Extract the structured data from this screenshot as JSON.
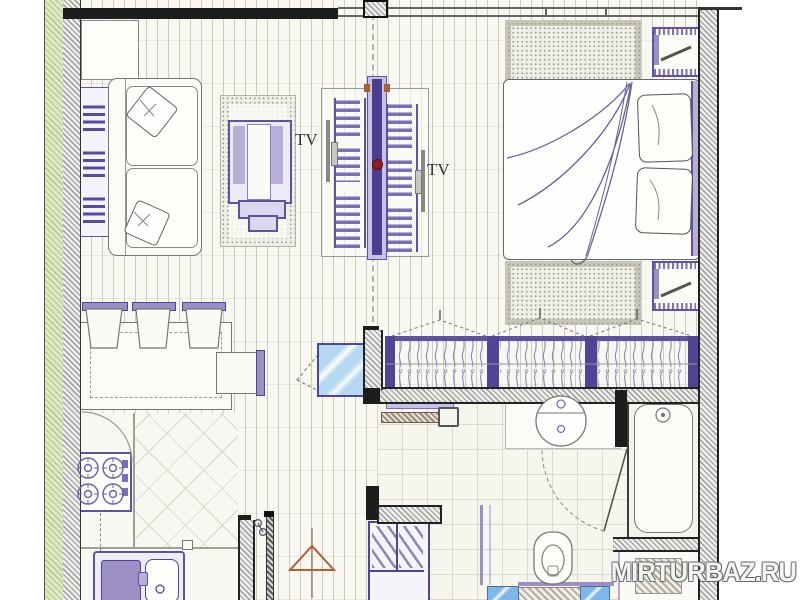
{
  "plan": {
    "labels": {
      "tv_left": "TV",
      "tv_right": "TV"
    },
    "watermark": "MIRTURBAZ.RU",
    "colors": {
      "furniture_outline_purple": "#4f4496",
      "furniture_fill_purple": "#9b8fc4",
      "furniture_pale_purple": "#c8c0e6",
      "wall_green": "#dfe9c0",
      "glass_blue": "#b5d9f2",
      "triangle_orange": "#b85c38",
      "wall_dark": "#1d1d1d",
      "floor_cream": "#f8f7f1"
    },
    "furniture": [
      "side-table",
      "bookshelf",
      "sofa",
      "pillows",
      "rug",
      "armchair",
      "tv-unit",
      "bed",
      "blanket",
      "nightstands",
      "bedroom-rugs",
      "dining-table",
      "chairs",
      "radiator",
      "glass-panel",
      "wardrobe-hangers",
      "stove",
      "kitchen-sink",
      "entrance-door",
      "shoe-cabinet",
      "direction-triangle",
      "towel-rails",
      "bathroom-sink",
      "toilet",
      "bath-mat",
      "bathtub"
    ]
  }
}
